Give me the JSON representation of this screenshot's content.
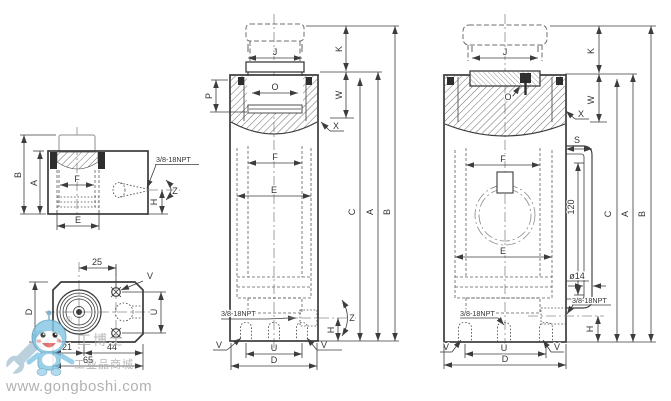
{
  "colors": {
    "line": "#3c3c3c",
    "centerline": "#8b8b8b",
    "label": "#333333",
    "watermark_blue": "#85c6e4",
    "watermark_gray": "#b1b1b1"
  },
  "views": {
    "left_section": {
      "label_B": "B",
      "label_A": "A",
      "label_F": "F",
      "label_E": "E",
      "label_H": "H",
      "label_Z": "Z",
      "port": "3/8-18NPT"
    },
    "bottom_view": {
      "dim_25": "25",
      "label_V": "V",
      "label_D": "D",
      "label_U": "U",
      "dim_21": "21",
      "dim_44": "44",
      "dim_65": "65"
    },
    "front_section": {
      "label_J": "J",
      "label_K": "K",
      "label_P": "P",
      "label_O": "O",
      "label_W": "W",
      "label_X": "X",
      "label_F": "F",
      "label_E": "E",
      "label_C": "C",
      "label_A": "A",
      "label_B": "B",
      "label_Z": "Z",
      "label_H": "H",
      "label_U": "U",
      "label_D": "D",
      "label_V_left": "V",
      "label_V_right": "V",
      "port": "3/8-18NPT"
    },
    "right_section": {
      "label_J": "J",
      "label_K": "K",
      "label_O": "O",
      "label_W": "W",
      "label_X": "X",
      "label_S": "S",
      "label_F": "F",
      "label_E": "E",
      "label_C": "C",
      "label_A": "A",
      "label_B": "B",
      "label_H": "H",
      "label_U": "U",
      "label_D": "D",
      "label_V_left": "V",
      "label_V_right": "V",
      "dim_120": "120",
      "dim_dia14": "ø14",
      "port_side": "3/8-18NPT",
      "port_bottom": "3/8-18NPT"
    }
  },
  "watermark": {
    "site": "www.gongboshi.com",
    "brand_cn": "工博士",
    "mall_cn": "工业品商城",
    "registered": "®"
  }
}
